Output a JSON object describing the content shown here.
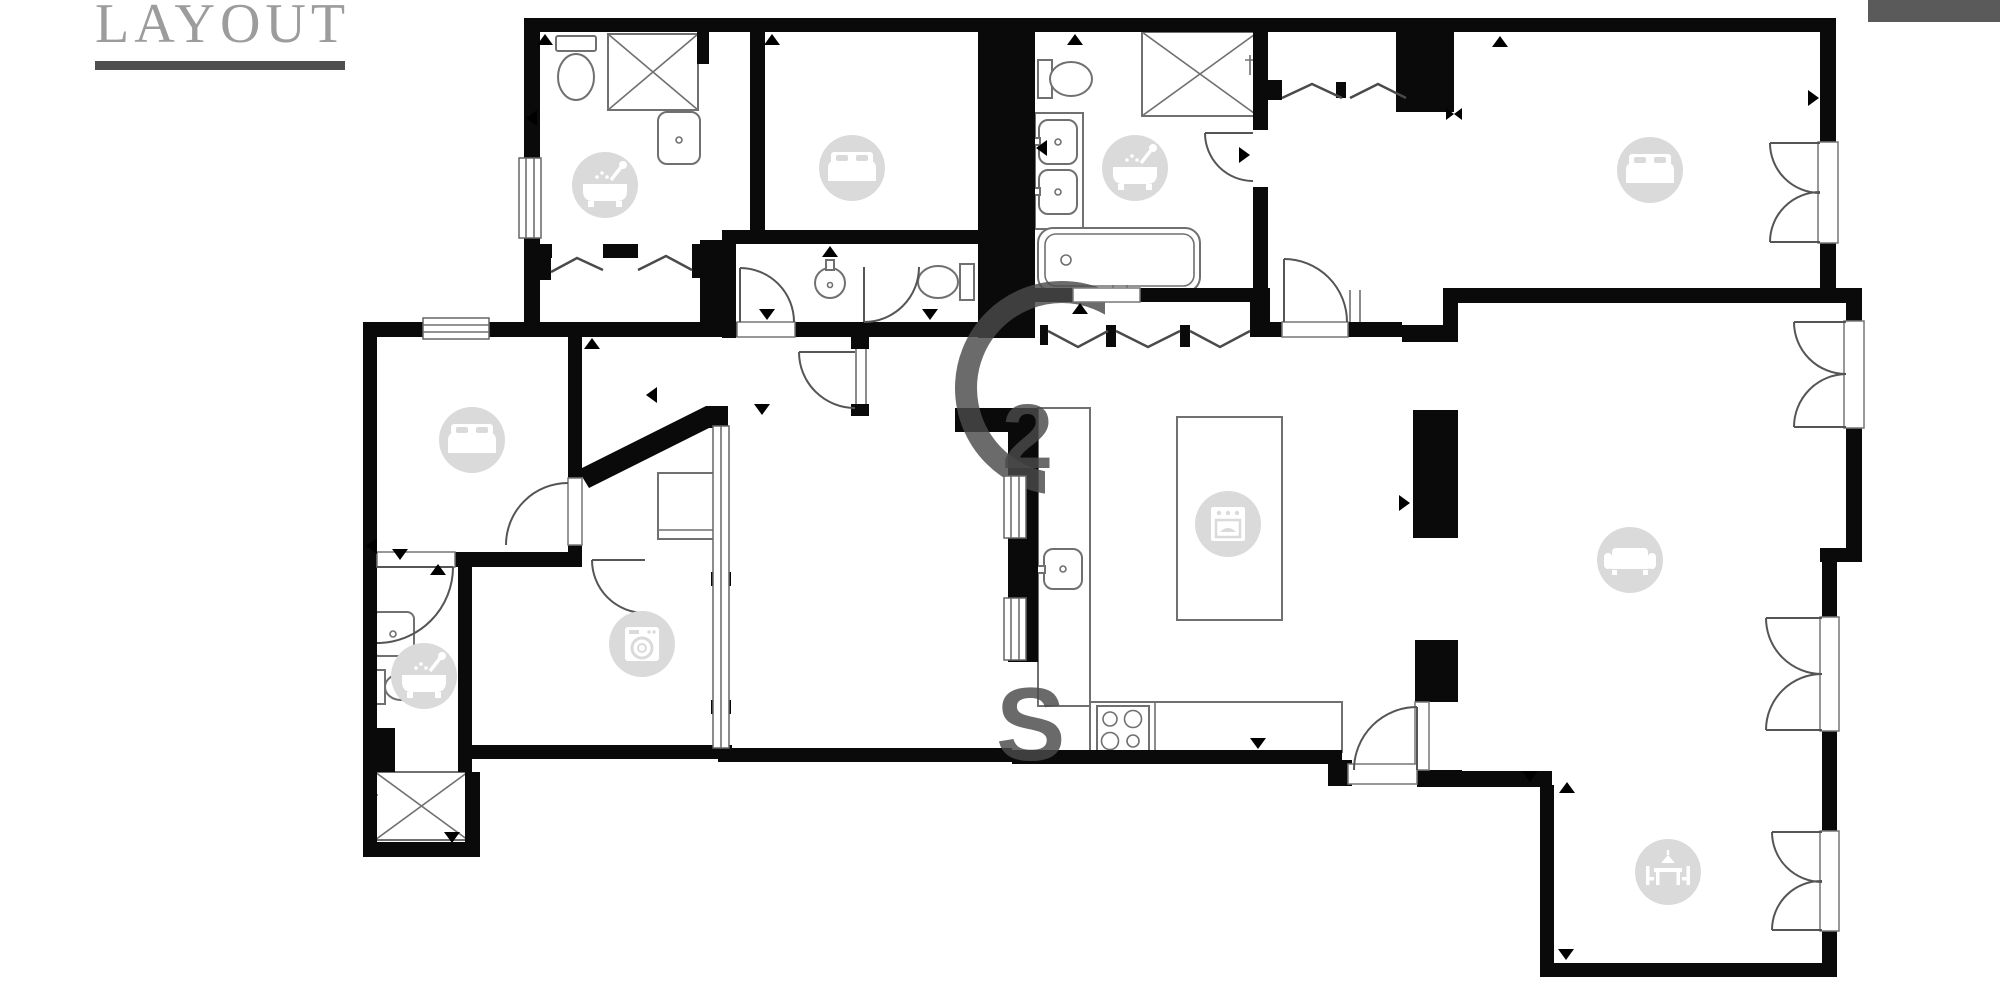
{
  "header": {
    "title": "LAYOUT",
    "title_color": "#9c9c9c",
    "underline_color": "#4f4f4f"
  },
  "top_right_bar": {
    "color": "#5a5a5a"
  },
  "colors": {
    "wall": "#0a0a0a",
    "floor": "#ffffff",
    "fixture_outline": "#707070",
    "door_arc": "#555555",
    "icon_bg": "#dadada",
    "icon_glyph": "#ffffff",
    "watermark": "#4a4a4a"
  },
  "plan": {
    "icons": [
      {
        "type": "bathtub",
        "name": "bathtub-icon",
        "cx": 605,
        "cy": 185
      },
      {
        "type": "bed",
        "name": "bed-icon",
        "cx": 852,
        "cy": 168
      },
      {
        "type": "bathtub",
        "name": "bathtub-icon",
        "cx": 1135,
        "cy": 168
      },
      {
        "type": "bed",
        "name": "bed-icon",
        "cx": 1650,
        "cy": 170
      },
      {
        "type": "bed",
        "name": "bed-icon",
        "cx": 472,
        "cy": 440
      },
      {
        "type": "bathtub",
        "name": "bathtub-icon",
        "cx": 424,
        "cy": 676
      },
      {
        "type": "washing-machine",
        "name": "washing-machine-icon",
        "cx": 642,
        "cy": 644
      },
      {
        "type": "oven",
        "name": "oven-icon",
        "cx": 1228,
        "cy": 524
      },
      {
        "type": "sofa",
        "name": "sofa-icon",
        "cx": 1630,
        "cy": 560
      },
      {
        "type": "dining-table",
        "name": "dining-table-icon",
        "cx": 1668,
        "cy": 872
      }
    ],
    "watermark": {
      "fragments": [
        {
          "char": "2"
        },
        {
          "char": "S"
        }
      ]
    }
  }
}
